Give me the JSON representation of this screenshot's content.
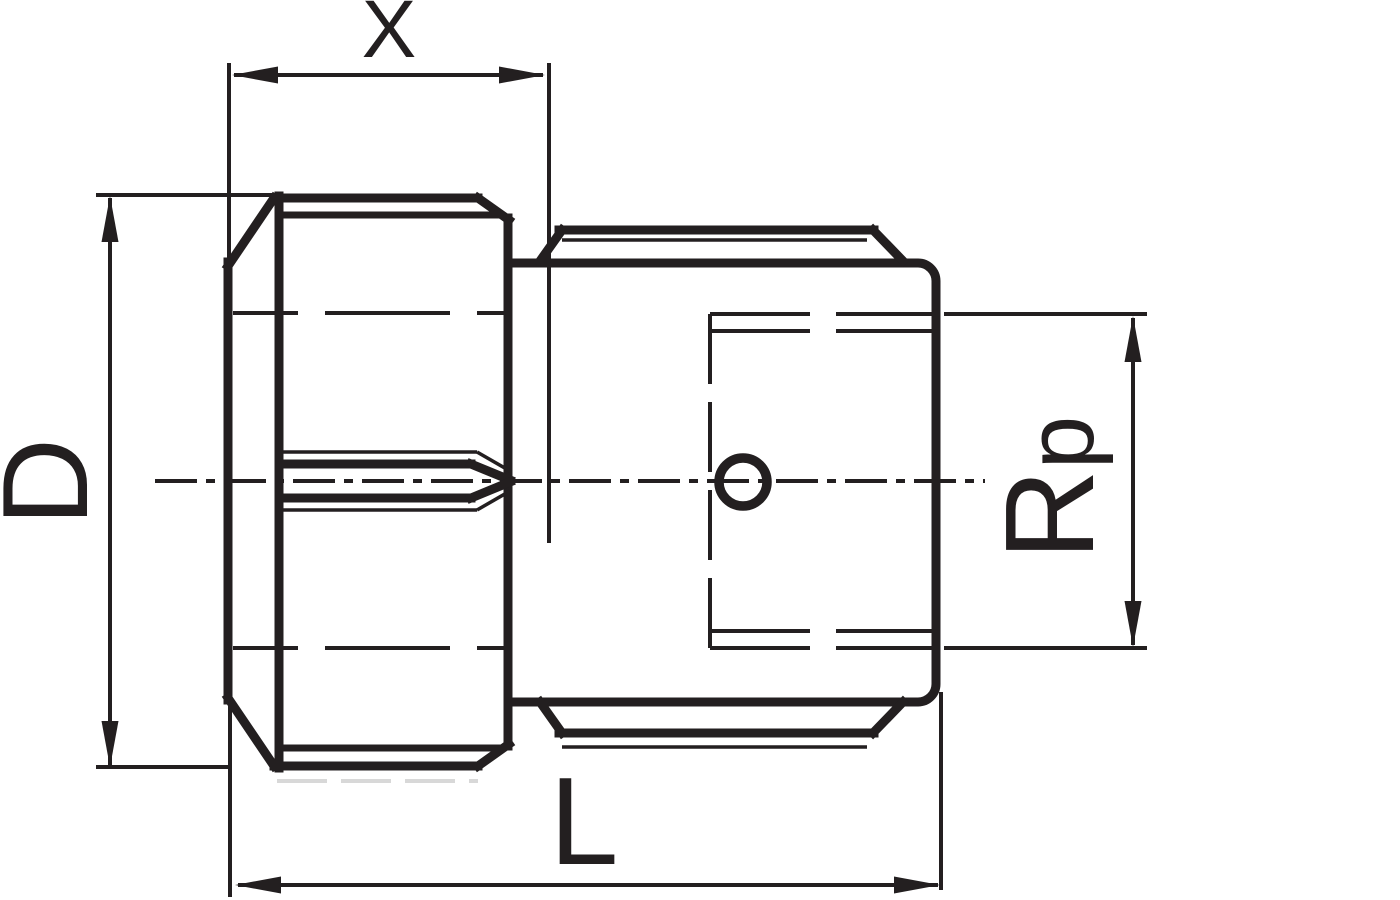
{
  "drawing": {
    "colors": {
      "line": "#231f20",
      "background": "#ffffff",
      "ghost_line": "#d8d8d8"
    },
    "dimensions": {
      "x": {
        "label": "X"
      },
      "d": {
        "label": "D"
      },
      "l": {
        "label": "L"
      },
      "rp": {
        "label_main": "R",
        "label_sub": "p"
      }
    }
  }
}
